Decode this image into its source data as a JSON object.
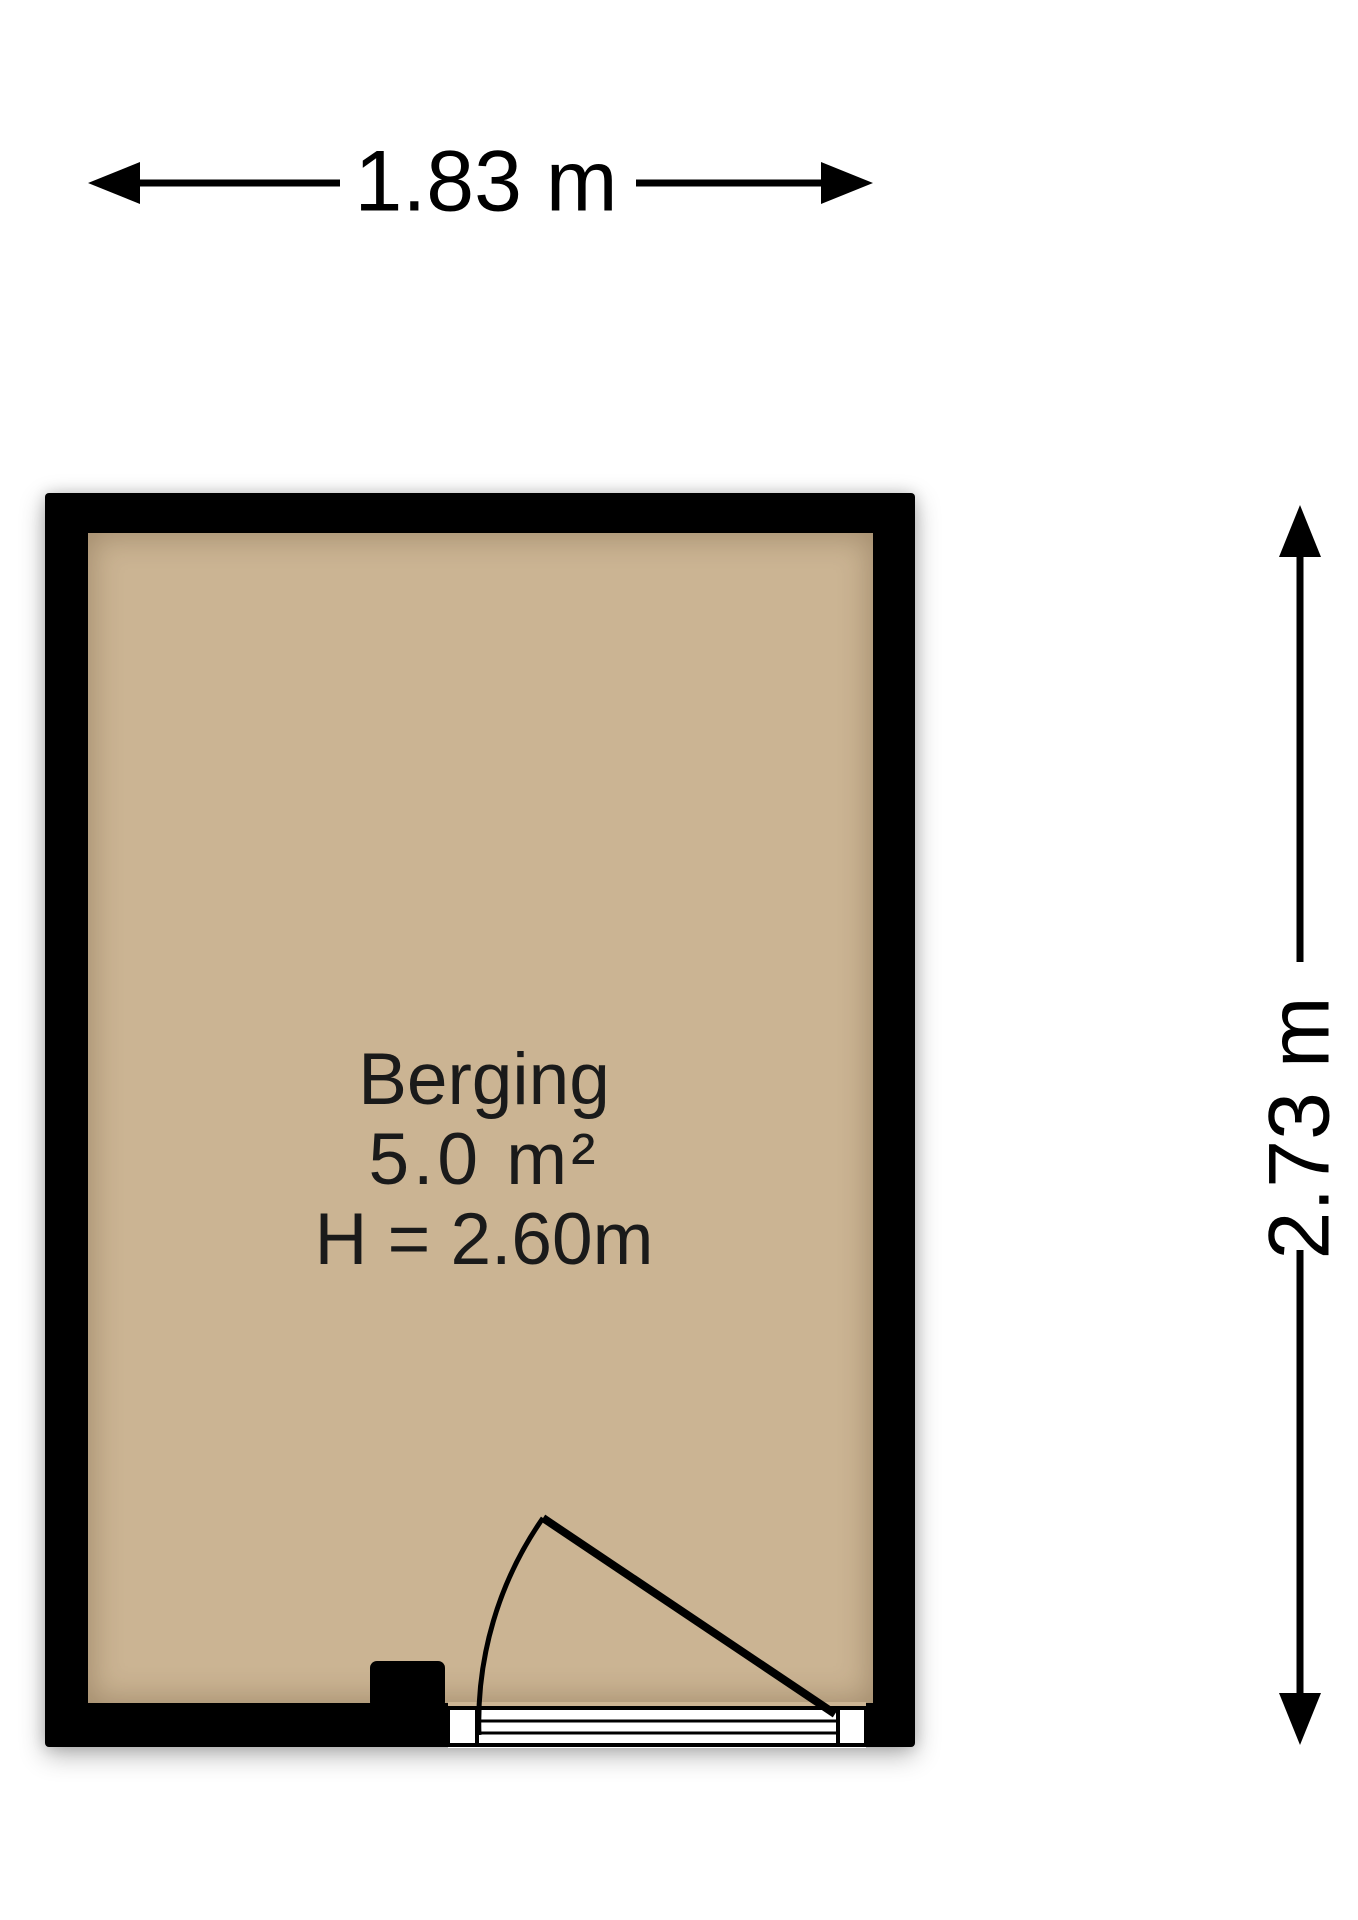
{
  "floorplan": {
    "room": {
      "name": "Berging",
      "area": "5.0 m²",
      "ceiling_height": "H = 2.60m"
    },
    "dimensions": {
      "width_label": "1.83 m",
      "height_label": "2.73 m"
    },
    "colors": {
      "floor": "#cbb493",
      "wall": "#000000",
      "lines": "#000000",
      "background": "#ffffff"
    },
    "symbols": {
      "door": "door-swing-arc",
      "width_arrow": "double-headed-horizontal-arrow",
      "height_arrow": "double-headed-vertical-arrow"
    }
  }
}
